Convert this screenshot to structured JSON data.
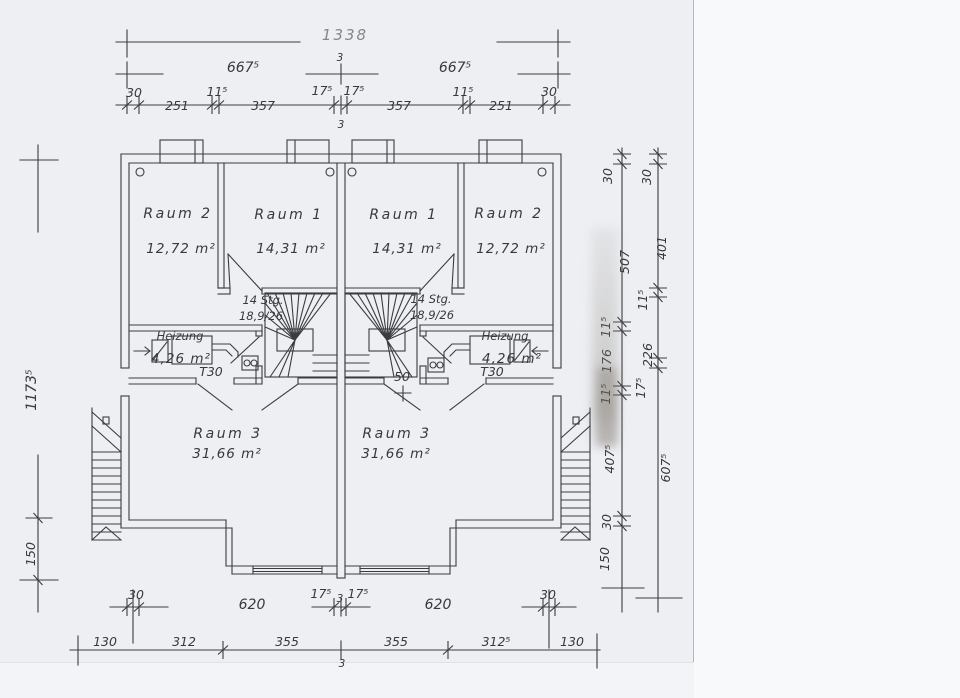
{
  "colors": {
    "paper": "#edeff3",
    "paper_edge": "#f8f9fb",
    "ink": "#3b3c40",
    "smudge": "#8f897e"
  },
  "dims": {
    "top": {
      "total": "1338",
      "left_half": "667⁵",
      "center_gap": "3",
      "right_half": "667⁵",
      "chain": [
        "30",
        "251",
        "11⁵",
        "357",
        "17⁵",
        "17⁵",
        "357",
        "11⁵",
        "251",
        "30"
      ],
      "center_gap_below": "3"
    },
    "bottom": {
      "upper": [
        "30",
        "620",
        "17⁵",
        "3",
        "17⁵",
        "620",
        "30"
      ],
      "lower": [
        "130",
        "312",
        "355",
        "355",
        "312⁵",
        "130"
      ],
      "center_gap_below": "3"
    },
    "left": {
      "total": "1173⁵",
      "stair": "150"
    },
    "right": {
      "inner": [
        "30",
        "507",
        "11⁵",
        "176",
        "11⁵",
        "407⁵",
        "30",
        "150"
      ],
      "outer": [
        "30",
        "401",
        "11⁵",
        "226",
        "17⁵",
        "607⁵"
      ]
    }
  },
  "rooms": {
    "left_unit": {
      "raum2": {
        "name": "Raum 2",
        "area": "12,72 m²"
      },
      "raum1": {
        "name": "Raum 1",
        "area": "14,31 m²"
      },
      "stairs": {
        "label": "14 Stg.",
        "rise": "18,9/26"
      },
      "heizung": {
        "name": "Heizung",
        "area": "4,26 m²",
        "door": "T30"
      },
      "raum3": {
        "name": "Raum 3",
        "area": "31,66 m²"
      }
    },
    "right_unit": {
      "raum1": {
        "name": "Raum 1",
        "area": "14,31 m²"
      },
      "raum2": {
        "name": "Raum 2",
        "area": "12,72 m²"
      },
      "stairs": {
        "label": "14 Stg.",
        "rise": "18,9/26"
      },
      "heizung": {
        "name": "Heizung",
        "area": "4,26 m²",
        "door": "T30"
      },
      "raum3": {
        "name": "Raum 3",
        "area": "31,66 m²"
      },
      "wall_stub": "50"
    }
  }
}
